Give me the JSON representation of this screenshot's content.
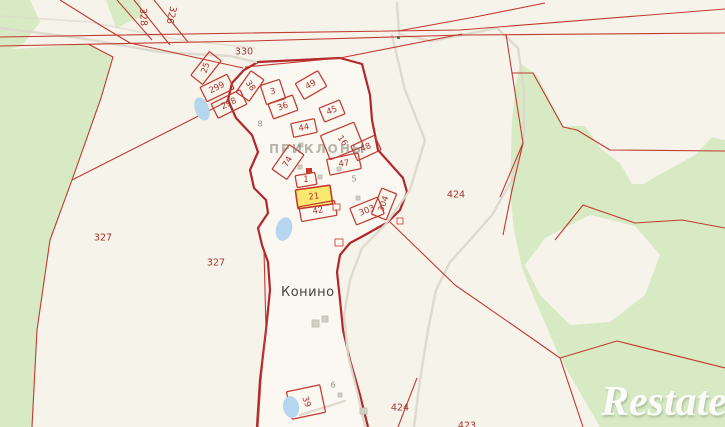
{
  "map": {
    "canvas": {
      "w": 725,
      "h": 427
    },
    "palette": {
      "bg": "#f6f3ea",
      "village_fill": "#faf8f1",
      "forest": "#d7eac3",
      "water": "#b5d6ee",
      "road": "#dcd8cb",
      "red_line": "#c23a30",
      "boundary": "#b2262c",
      "label_red": "#a7342d",
      "label_gray": "#8f8c82",
      "building_gray": "#d2cfc3",
      "building_stroke": "#bdbab0",
      "building_red": "#c8362c",
      "highlight_fill": "#fae96f",
      "dot_dark": "#6b6962"
    },
    "texts": {
      "settlement": "Конино",
      "district": "ПРИКЛОНЫ",
      "watermark": "Restate"
    },
    "area_labels": [
      {
        "t": "328",
        "x": 143,
        "y": 17,
        "r": 88
      },
      {
        "t": "326",
        "x": 171,
        "y": 15,
        "r": 102
      },
      {
        "t": "330",
        "x": 244,
        "y": 52,
        "r": 0
      },
      {
        "t": "327",
        "x": 103,
        "y": 238,
        "r": 0
      },
      {
        "t": "327",
        "x": 216,
        "y": 263,
        "r": 0
      },
      {
        "t": "424",
        "x": 456,
        "y": 195,
        "r": 0
      },
      {
        "t": "424",
        "x": 400,
        "y": 408,
        "r": 0
      },
      {
        "t": "423",
        "x": 467,
        "y": 426,
        "r": 0
      }
    ],
    "minor_labels": [
      {
        "t": "8",
        "x": 260,
        "y": 124
      },
      {
        "t": "5",
        "x": 354,
        "y": 179
      },
      {
        "t": "6",
        "x": 333,
        "y": 385
      }
    ],
    "parcels": [
      {
        "id": "25",
        "cx": 206,
        "cy": 68,
        "w": 15,
        "h": 30,
        "rot": 38,
        "lrot": -72
      },
      {
        "id": "299",
        "cx": 217,
        "cy": 88,
        "w": 30,
        "h": 16,
        "rot": -26,
        "lrot": -26
      },
      {
        "id": "298",
        "cx": 229,
        "cy": 104,
        "w": 32,
        "h": 16,
        "rot": -26,
        "lrot": -26
      },
      {
        "id": "38",
        "cx": 250,
        "cy": 86,
        "w": 16,
        "h": 26,
        "rot": 35,
        "lrot": 55
      },
      {
        "id": "3",
        "cx": 273,
        "cy": 92,
        "w": 20,
        "h": 20,
        "rot": -18,
        "lrot": -10
      },
      {
        "id": "36",
        "cx": 283,
        "cy": 107,
        "w": 26,
        "h": 16,
        "rot": -20,
        "lrot": -20
      },
      {
        "id": "49",
        "cx": 311,
        "cy": 85,
        "w": 26,
        "h": 18,
        "rot": -30,
        "lrot": -30
      },
      {
        "id": "45",
        "cx": 332,
        "cy": 111,
        "w": 22,
        "h": 15,
        "rot": -22,
        "lrot": -22
      },
      {
        "id": "44",
        "cx": 304,
        "cy": 128,
        "w": 24,
        "h": 14,
        "rot": -12,
        "lrot": -12
      },
      {
        "id": "16",
        "cx": 342,
        "cy": 141,
        "w": 36,
        "h": 26,
        "rot": -22,
        "lrot": 55
      },
      {
        "id": "48",
        "cx": 366,
        "cy": 148,
        "w": 26,
        "h": 16,
        "rot": -25,
        "lrot": -25
      },
      {
        "id": "47",
        "cx": 344,
        "cy": 164,
        "w": 32,
        "h": 16,
        "rot": -12,
        "lrot": -8
      },
      {
        "id": "74",
        "cx": 288,
        "cy": 162,
        "w": 18,
        "h": 30,
        "rot": 35,
        "lrot": -60
      },
      {
        "id": "1",
        "cx": 306,
        "cy": 180,
        "w": 20,
        "h": 12,
        "rot": -10,
        "lrot": 0
      },
      {
        "id": "21",
        "cx": 314,
        "cy": 197,
        "w": 35,
        "h": 19,
        "rot": -8,
        "lrot": -8,
        "hl": true
      },
      {
        "id": "42",
        "cx": 318,
        "cy": 211,
        "w": 36,
        "h": 15,
        "rot": -10,
        "lrot": -10
      },
      {
        "id": "303",
        "cx": 367,
        "cy": 211,
        "w": 30,
        "h": 18,
        "rot": -22,
        "lrot": -22
      },
      {
        "id": "304",
        "cx": 384,
        "cy": 204,
        "w": 16,
        "h": 28,
        "rot": 22,
        "lrot": -70
      },
      {
        "id": "39",
        "cx": 306,
        "cy": 402,
        "w": 34,
        "h": 28,
        "rot": -12,
        "lrot": 70
      }
    ],
    "geometry": {
      "forest": [
        [
          [
            0,
            0
          ],
          [
            30,
            0
          ],
          [
            40,
            22
          ],
          [
            22,
            46
          ],
          [
            0,
            52
          ]
        ],
        [
          [
            106,
            0
          ],
          [
            140,
            0
          ],
          [
            143,
            16
          ],
          [
            116,
            28
          ]
        ],
        [
          [
            0,
            50
          ],
          [
            60,
            46
          ],
          [
            88,
            44
          ],
          [
            113,
            57
          ],
          [
            101,
            98
          ],
          [
            72,
            180
          ],
          [
            50,
            240
          ],
          [
            37,
            330
          ],
          [
            32,
            427
          ],
          [
            0,
            427
          ]
        ],
        [
          [
            520,
            63
          ],
          [
            537,
            75
          ],
          [
            563,
            126
          ],
          [
            585,
            126
          ],
          [
            602,
            150
          ],
          [
            620,
            163
          ],
          [
            632,
            184
          ],
          [
            643,
            184
          ],
          [
            668,
            170
          ],
          [
            695,
            155
          ],
          [
            712,
            137
          ],
          [
            725,
            140
          ],
          [
            725,
            427
          ],
          [
            600,
            427
          ],
          [
            560,
            358
          ],
          [
            548,
            330
          ],
          [
            535,
            300
          ],
          [
            522,
            268
          ],
          [
            514,
            230
          ],
          [
            510,
            190
          ],
          [
            512,
            120
          ],
          [
            516,
            85
          ]
        ]
      ],
      "bg_patches": [
        [
          [
            545,
            238
          ],
          [
            590,
            215
          ],
          [
            635,
            226
          ],
          [
            660,
            255
          ],
          [
            645,
            295
          ],
          [
            610,
            322
          ],
          [
            570,
            325
          ],
          [
            540,
            295
          ],
          [
            525,
            265
          ]
        ]
      ],
      "village": [
        [
          257,
          427
        ],
        [
          260,
          380
        ],
        [
          266,
          330
        ],
        [
          270,
          290
        ],
        [
          268,
          262
        ],
        [
          262,
          245
        ],
        [
          258,
          228
        ],
        [
          268,
          213
        ],
        [
          266,
          200
        ],
        [
          254,
          188
        ],
        [
          250,
          170
        ],
        [
          258,
          152
        ],
        [
          252,
          135
        ],
        [
          236,
          118
        ],
        [
          228,
          100
        ],
        [
          232,
          83
        ],
        [
          244,
          70
        ],
        [
          258,
          62
        ],
        [
          300,
          60
        ],
        [
          340,
          58
        ],
        [
          362,
          64
        ],
        [
          370,
          95
        ],
        [
          372,
          120
        ],
        [
          378,
          150
        ],
        [
          403,
          178
        ],
        [
          407,
          192
        ],
        [
          400,
          210
        ],
        [
          388,
          222
        ],
        [
          365,
          235
        ],
        [
          350,
          243
        ],
        [
          340,
          255
        ],
        [
          337,
          272
        ],
        [
          340,
          300
        ],
        [
          343,
          330
        ],
        [
          350,
          360
        ],
        [
          360,
          395
        ],
        [
          368,
          427
        ]
      ],
      "roads": [
        [
          [
            0,
            28
          ],
          [
            80,
            38
          ],
          [
            160,
            52
          ],
          [
            230,
            56
          ],
          [
            256,
            62
          ]
        ],
        [
          [
            0,
            16
          ],
          [
            90,
            22
          ],
          [
            180,
            40
          ],
          [
            255,
            48
          ]
        ],
        [
          [
            397,
            3
          ],
          [
            399,
            34
          ],
          [
            432,
            41
          ],
          [
            497,
            28
          ],
          [
            518,
            48
          ],
          [
            524,
            90
          ],
          [
            524,
            140
          ],
          [
            512,
            180
          ],
          [
            492,
            215
          ],
          [
            470,
            240
          ],
          [
            450,
            262
          ],
          [
            436,
            290
          ],
          [
            428,
            330
          ],
          [
            420,
            380
          ],
          [
            414,
            427
          ]
        ],
        [
          [
            392,
            35
          ],
          [
            405,
            90
          ],
          [
            425,
            140
          ],
          [
            410,
            190
          ],
          [
            385,
            225
          ],
          [
            362,
            248
          ],
          [
            350,
            280
          ],
          [
            344,
            315
          ],
          [
            348,
            355
          ],
          [
            358,
            395
          ],
          [
            365,
            427
          ]
        ],
        [
          [
            300,
            415
          ],
          [
            345,
            401
          ]
        ]
      ],
      "red_lines": [
        [
          [
            0,
            37
          ],
          [
            250,
            33
          ],
          [
            460,
            30
          ],
          [
            725,
            9
          ]
        ],
        [
          [
            0,
            46
          ],
          [
            250,
            41
          ],
          [
            462,
            35
          ],
          [
            725,
            33
          ]
        ],
        [
          [
            398,
            31
          ],
          [
            475,
            17
          ],
          [
            545,
            3
          ]
        ],
        [
          [
            506,
            34
          ],
          [
            512,
            73
          ],
          [
            523,
            143
          ],
          [
            500,
            197
          ]
        ],
        [
          [
            512,
            73
          ],
          [
            533,
            73
          ],
          [
            563,
            127
          ],
          [
            577,
            130
          ],
          [
            610,
            150
          ],
          [
            725,
            151
          ]
        ],
        [
          [
            523,
            143
          ],
          [
            512,
            190
          ],
          [
            503,
            235
          ]
        ],
        [
          [
            583,
            205
          ],
          [
            635,
            223
          ],
          [
            682,
            220
          ],
          [
            725,
            228
          ]
        ],
        [
          [
            583,
            205
          ],
          [
            555,
            240
          ]
        ],
        [
          [
            390,
            222
          ],
          [
            455,
            285
          ],
          [
            520,
            330
          ],
          [
            560,
            358
          ]
        ],
        [
          [
            560,
            358
          ],
          [
            617,
            341
          ],
          [
            725,
            368
          ]
        ],
        [
          [
            560,
            358
          ],
          [
            583,
            427
          ]
        ],
        [
          [
            117,
            0
          ],
          [
            152,
            40
          ]
        ],
        [
          [
            134,
            0
          ],
          [
            170,
            45
          ]
        ],
        [
          [
            154,
            0
          ],
          [
            188,
            42
          ]
        ],
        [
          [
            60,
            0
          ],
          [
            100,
            25
          ],
          [
            130,
            43
          ]
        ],
        [
          [
            130,
            43
          ],
          [
            243,
            68
          ]
        ],
        [
          [
            245,
            67
          ],
          [
            340,
            58
          ],
          [
            462,
            34
          ]
        ],
        [
          [
            88,
            44
          ],
          [
            113,
            57
          ],
          [
            101,
            98
          ],
          [
            72,
            180
          ],
          [
            50,
            240
          ],
          [
            37,
            330
          ],
          [
            32,
            427
          ]
        ],
        [
          [
            72,
            180
          ],
          [
            230,
            100
          ]
        ],
        [
          [
            417,
            378
          ],
          [
            398,
            427
          ]
        ],
        [
          [
            264,
            250
          ],
          [
            266,
            330
          ],
          [
            261,
            380
          ],
          [
            258,
            427
          ]
        ]
      ],
      "ponds": [
        {
          "cx": 202,
          "cy": 109,
          "rx": 7,
          "ry": 12,
          "r": -20
        },
        {
          "cx": 284,
          "cy": 229,
          "rx": 8,
          "ry": 12,
          "r": 15
        },
        {
          "cx": 291,
          "cy": 407,
          "rx": 8,
          "ry": 11,
          "r": -10
        }
      ],
      "buildings": [
        {
          "x": 312,
          "y": 320,
          "w": 7,
          "h": 7,
          "type": "gray"
        },
        {
          "x": 322,
          "y": 316,
          "w": 6,
          "h": 6,
          "type": "gray"
        },
        {
          "x": 360,
          "y": 408,
          "w": 7,
          "h": 6,
          "type": "gray"
        },
        {
          "x": 298,
          "y": 165,
          "w": 4,
          "h": 4,
          "type": "gray"
        },
        {
          "x": 318,
          "y": 175,
          "w": 4,
          "h": 4,
          "type": "gray"
        },
        {
          "x": 337,
          "y": 167,
          "w": 4,
          "h": 4,
          "type": "gray"
        },
        {
          "x": 299,
          "y": 143,
          "w": 4,
          "h": 4,
          "type": "gray"
        },
        {
          "x": 356,
          "y": 196,
          "w": 4,
          "h": 4,
          "type": "gray"
        },
        {
          "x": 338,
          "y": 393,
          "w": 4,
          "h": 4,
          "type": "gray"
        },
        {
          "x": 397,
          "y": 36,
          "w": 3,
          "h": 3,
          "type": "dot"
        },
        {
          "x": 306,
          "y": 168,
          "w": 6,
          "h": 5,
          "type": "red"
        },
        {
          "x": 333,
          "y": 204,
          "w": 7,
          "h": 6,
          "type": "outline"
        },
        {
          "x": 397,
          "y": 218,
          "w": 6,
          "h": 6,
          "type": "outline"
        },
        {
          "x": 335,
          "y": 239,
          "w": 8,
          "h": 7,
          "type": "outline"
        }
      ]
    }
  }
}
